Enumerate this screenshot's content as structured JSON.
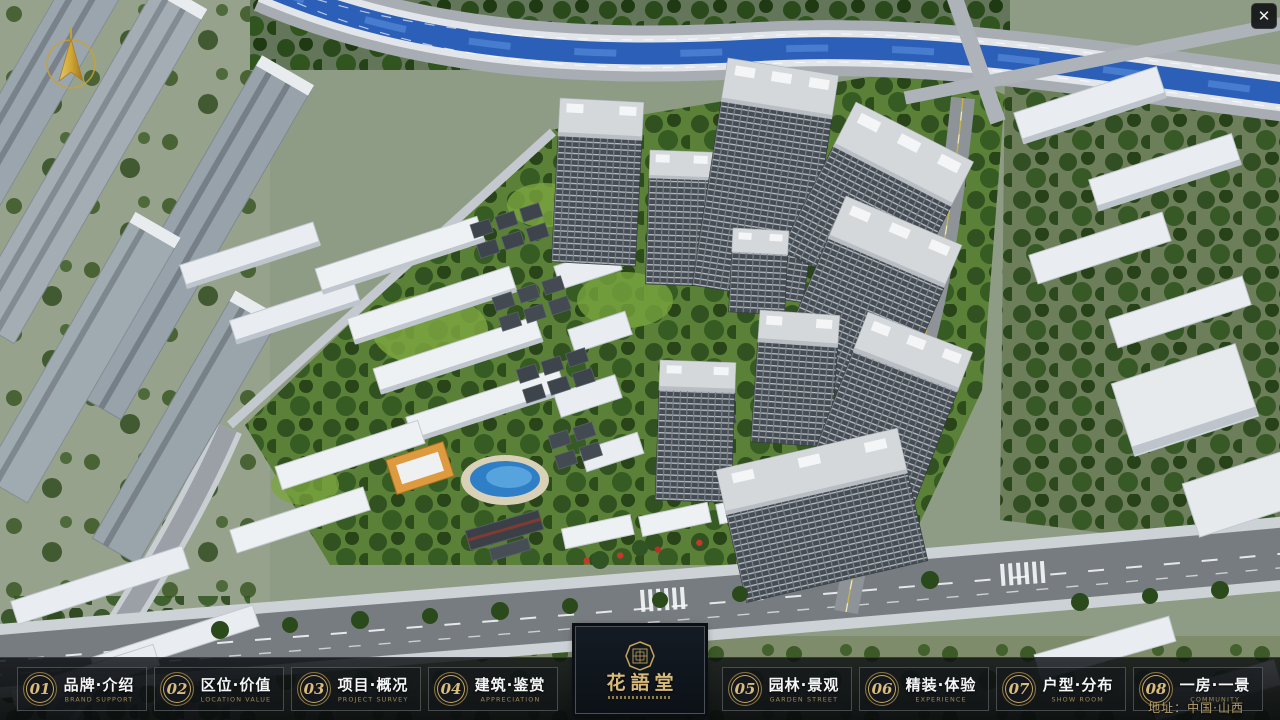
{
  "window": {
    "close_icon": "✕"
  },
  "icons": {
    "close": "close-x",
    "compass": "north-compass-arrow",
    "logo_seal": "octagonal-gold-seal"
  },
  "navbar": {
    "items": [
      {
        "num": "01",
        "label": "品牌·介绍",
        "sub": "BRAND SUPPORT"
      },
      {
        "num": "02",
        "label": "区位·价值",
        "sub": "LOCATION VALUE"
      },
      {
        "num": "03",
        "label": "项目·概况",
        "sub": "PROJECT SURVEY"
      },
      {
        "num": "04",
        "label": "建筑·鉴赏",
        "sub": "APPRECIATION"
      },
      {
        "num": "05",
        "label": "园林·景观",
        "sub": "GARDEN STREET"
      },
      {
        "num": "06",
        "label": "精装·体验",
        "sub": "EXPERIENCE"
      },
      {
        "num": "07",
        "label": "户型·分布",
        "sub": "SHOW ROOM"
      },
      {
        "num": "08",
        "label": "一房·一景",
        "sub": "COMMUNITY"
      }
    ],
    "logo_title": "花語堂"
  },
  "footer": {
    "address": "地址：中国·山西"
  },
  "colors": {
    "accent_gold": "#c8a85e",
    "navbar_bg": "rgba(10,13,16,0.88)",
    "river_blue": "#2c5fb8",
    "grass_green": "#5b8038"
  }
}
